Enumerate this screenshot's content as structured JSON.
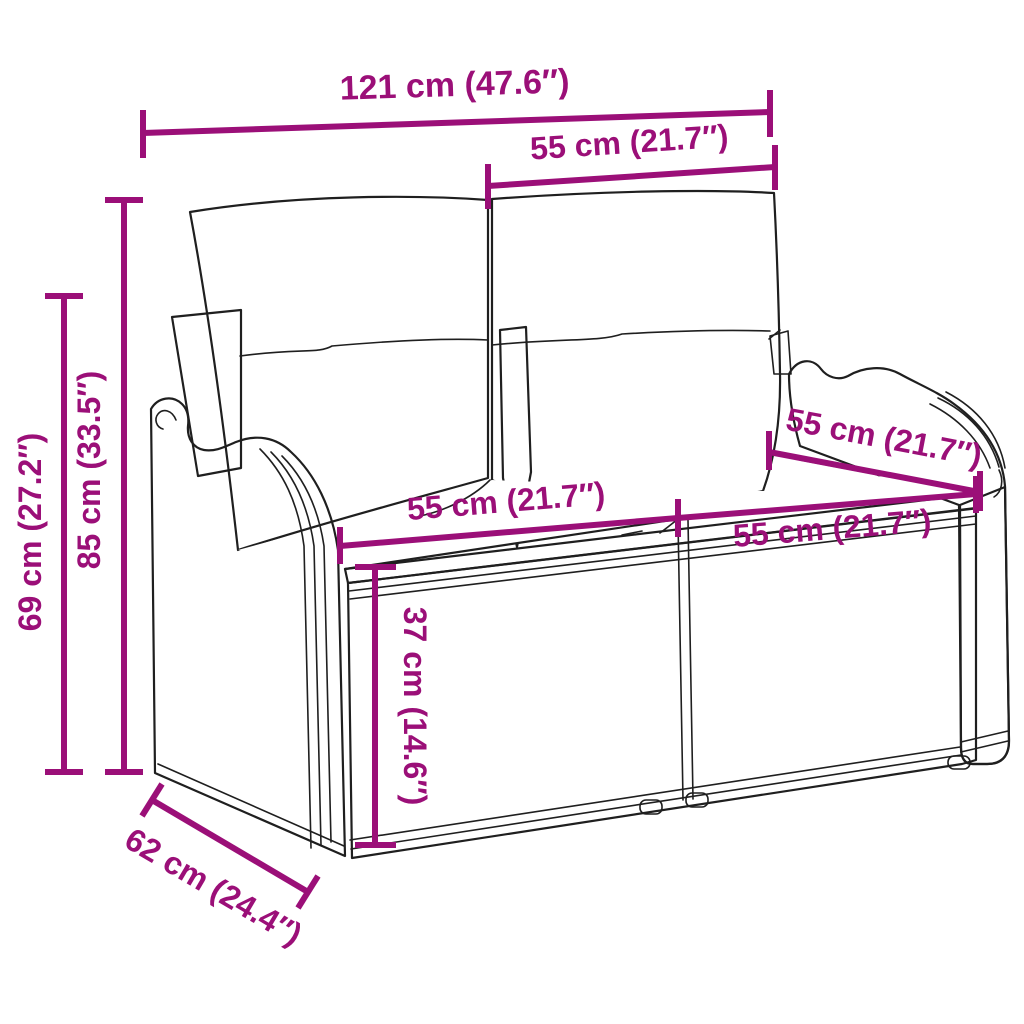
{
  "figure": {
    "type": "product-dimension-diagram",
    "subject": "rattan-garden-bench-with-cushions"
  },
  "colors": {
    "accent": "#9B0F78",
    "outline": "#1F1F1F",
    "background": "#FFFFFF"
  },
  "dimensions": {
    "overall_width": {
      "label": "121 cm (47.6″)"
    },
    "backrest_width": {
      "label": "55 cm (21.7″)"
    },
    "overall_height": {
      "label": "85 cm (33.5″)"
    },
    "armrest_height": {
      "label": "69 cm (27.2″)"
    },
    "seat_width_left": {
      "label": "55 cm (21.7″)"
    },
    "seat_width_right": {
      "label": "55 cm (21.7″)"
    },
    "seat_depth_top": {
      "label": "55 cm (21.7″)"
    },
    "seat_height": {
      "label": "37 cm (14.6″)"
    },
    "overall_depth": {
      "label": "62 cm (24.4″)"
    }
  }
}
